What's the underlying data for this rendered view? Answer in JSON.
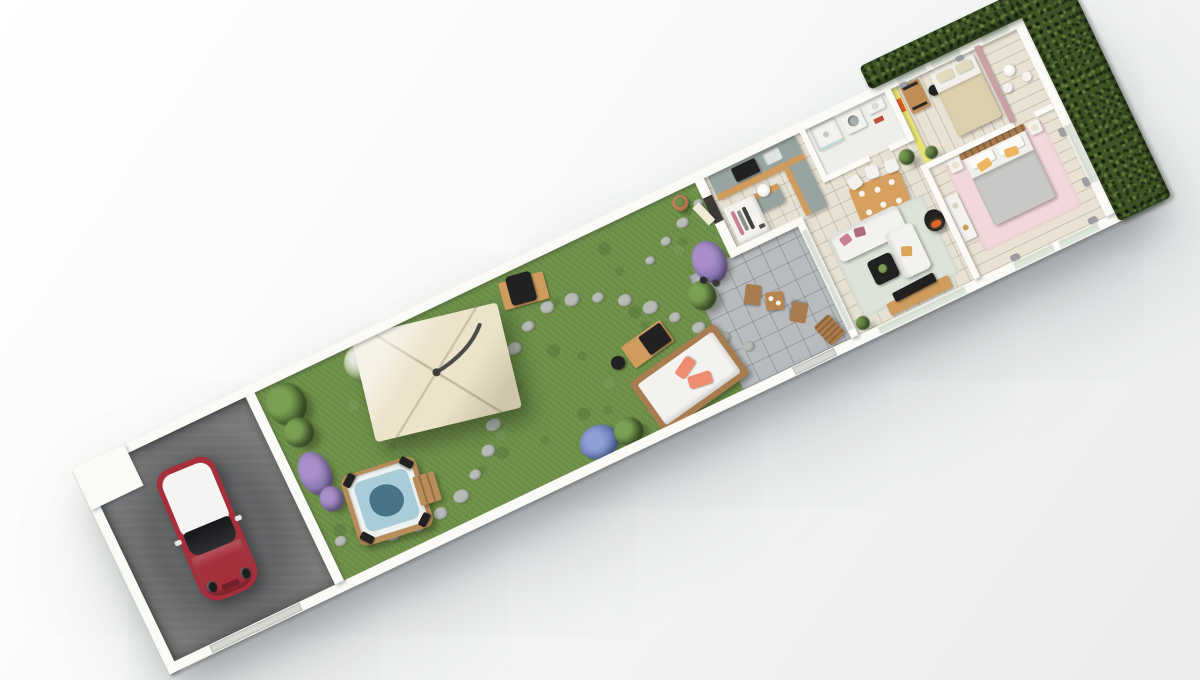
{
  "scene": {
    "kind": "3d-isometric-floor-plan-render",
    "plan_rotation_deg": -25.5,
    "background_top": "#ffffff",
    "background_bottom": "#e9ebec"
  },
  "palette": {
    "grass": "#6f9149",
    "stepping_stone": "#b7bcb7",
    "driveway": "#77797b",
    "wall": "#fbfaf6",
    "floor_tile": "#e7e1d3",
    "terrace_tile": "#b9bcbf",
    "hedge": "#3f5426",
    "canopy": "#ece3cb",
    "car_red": "#a62f3c",
    "car_roof": "#f4f4f2",
    "hot_tub_wood": "#b78d5c",
    "water": "#a9cdd8",
    "water_deep": "#477287",
    "outdoor_wood": "#a87c4e",
    "sofa_white": "#f3f2ef",
    "pillow_coral": "#ef8d70",
    "cabinet_sage": "#97a4a1",
    "counter_wood": "#cf9c5e",
    "dining_wood": "#d8a05e",
    "rug_living": "#dde3d8",
    "rug_pink": "#f2d8da",
    "stove_black": "#212121",
    "fire_orange": "#e2672a",
    "yellow_wall": "#e9e472",
    "artwork_orange": "#df5f2b",
    "bed_gray": "#c8c8c6",
    "pillow_yellow": "#efb55e",
    "partition_pink": "#c9a0a4",
    "gate": "#d6d7d3"
  },
  "driveway": {
    "objects": [
      "red-mini-car-white-roof",
      "concrete-slab",
      "entrance-gate"
    ]
  },
  "garden": {
    "objects": [
      "hot-tub-with-steps",
      "cantilever-canopy",
      "barbecue-grill",
      "outdoor-sofa",
      "garden-coffee-table",
      "kettle-grill",
      "stepping-stone-path",
      "shrubs",
      "lavender-bushes",
      "hydrangea-bush",
      "planter-pot"
    ],
    "stepping_stones": {
      "count": 26,
      "main_path": 22,
      "door_branch": 4
    }
  },
  "terrace": {
    "objects": [
      "bistro-table",
      "bistro-chairs",
      "sun-lounger",
      "wine-bottles"
    ],
    "bistro_chair_count": 2
  },
  "house": {
    "entry": {
      "objects": [
        "front-door",
        "open-wardrobe",
        "pouf"
      ]
    },
    "kitchen": {
      "objects": [
        "l-shaped-sage-cabinets",
        "wood-counter",
        "cooktop",
        "sink",
        "island"
      ]
    },
    "dining": {
      "objects": [
        "wood-dining-table",
        "white-chairs",
        "potted-plant"
      ],
      "chair_count": 6
    },
    "living_room": {
      "objects": [
        "white-corner-sofa",
        "pink-pillows",
        "coffee-table",
        "tv",
        "tv-sideboard",
        "wood-stove",
        "sage-rug",
        "plant"
      ]
    },
    "bathroom": {
      "objects": [
        "shower",
        "washing-machine",
        "wall-basin",
        "red-towel"
      ]
    },
    "bedroom_small": {
      "objects": [
        "double-bed",
        "desk",
        "desk-chair",
        "yellow-accent-wall",
        "orange-artwork"
      ],
      "window_count": 2
    },
    "bedroom_master": {
      "objects": [
        "double-bed",
        "slat-headboard",
        "nightstands",
        "table-lamps",
        "pink-rug",
        "pink-partition",
        "white-console",
        "corner-table"
      ],
      "nightstand_count": 2,
      "yellow_pillow_count": 2
    },
    "glazing": [
      "living-sliding-doors",
      "master-french-doors-south",
      "master-french-doors-east",
      "small-bedroom-windows"
    ]
  },
  "boundary": {
    "objects": [
      "perimeter-wall",
      "tall-hedge-l-shape",
      "driveway-gate",
      "terrace-gate"
    ]
  }
}
